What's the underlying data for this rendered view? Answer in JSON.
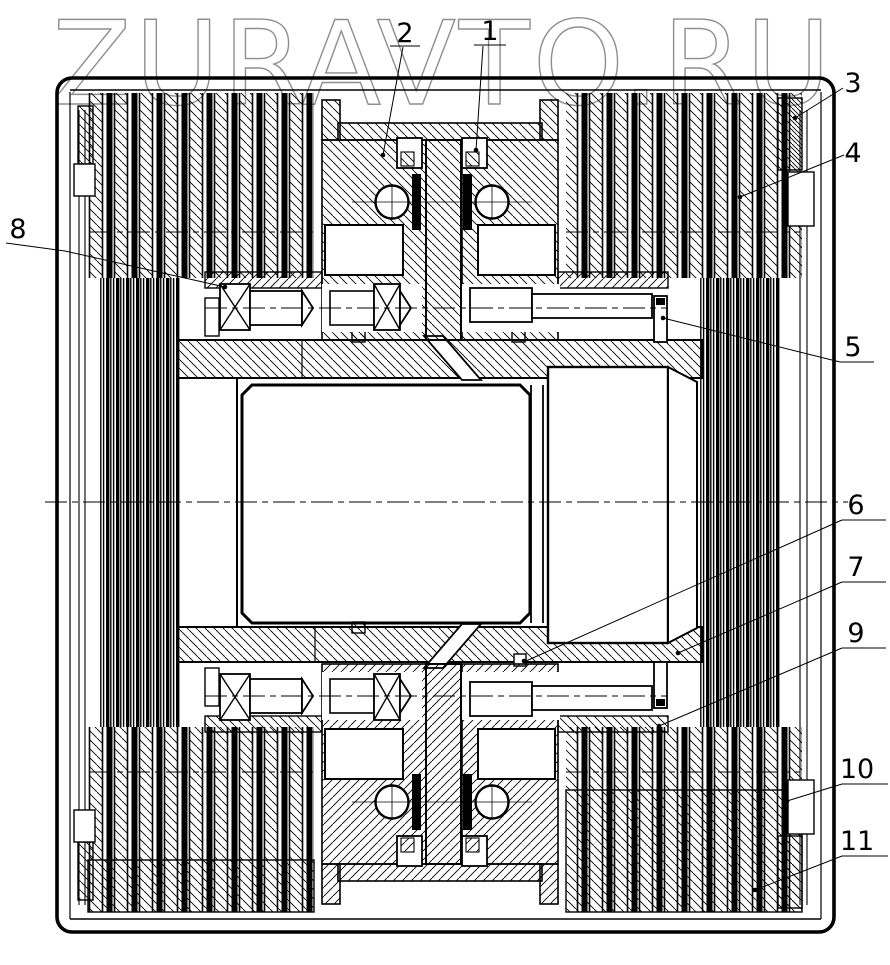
{
  "watermark": {
    "text": "ZURAVTO.RU",
    "color": "#8f8f8f"
  },
  "drawing": {
    "background": "#ffffff",
    "line_color": "#000000",
    "kind": "sectional engineering drawing with numbered part callouts"
  },
  "callouts": [
    {
      "id": 1,
      "label": "1"
    },
    {
      "id": 2,
      "label": "2"
    },
    {
      "id": 3,
      "label": "3"
    },
    {
      "id": 4,
      "label": "4"
    },
    {
      "id": 5,
      "label": "5"
    },
    {
      "id": 6,
      "label": "6"
    },
    {
      "id": 7,
      "label": "7"
    },
    {
      "id": 8,
      "label": "8"
    },
    {
      "id": 9,
      "label": "9"
    },
    {
      "id": 10,
      "label": "10"
    },
    {
      "id": 11,
      "label": "11"
    }
  ]
}
